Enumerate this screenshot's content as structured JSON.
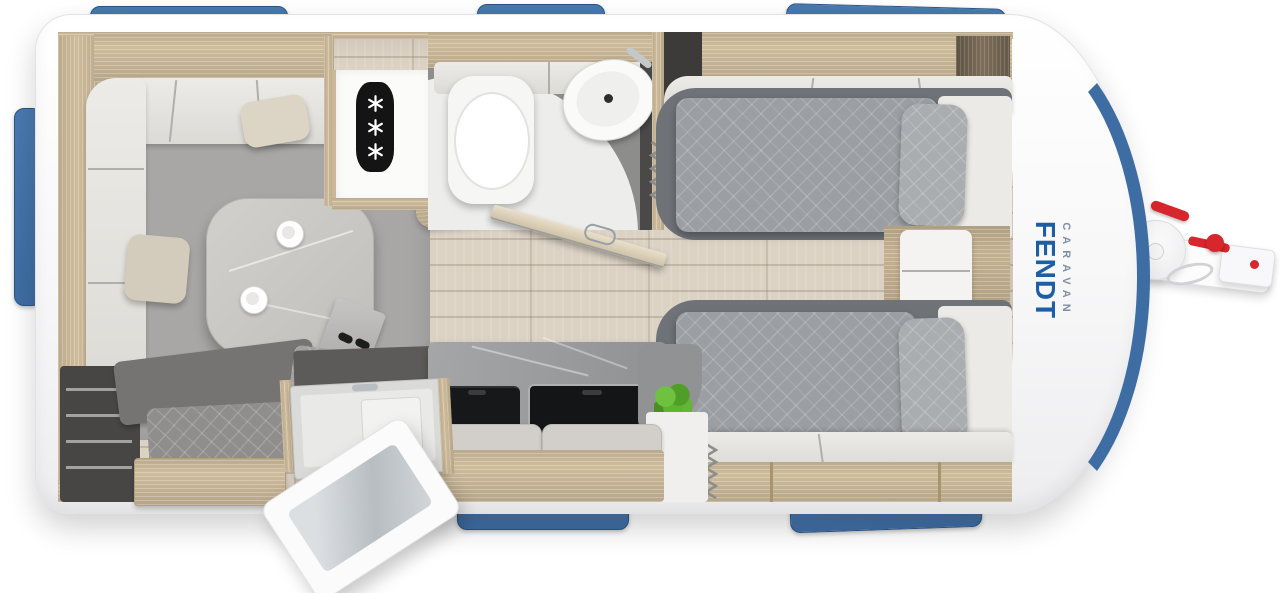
{
  "brand": {
    "name": "FENDT",
    "subtitle": "CARAVAN"
  },
  "colors": {
    "brand_blue": "#1d5fa7",
    "brand_sub": "#7e8ea3",
    "window_blue": "#3e6da3",
    "accent_red": "#d7262c",
    "wood": "#cfbc9b",
    "floor_wood": "#dbd2c4",
    "carpet_gray": "#a8a7a5",
    "bed_platform": "#6f7378",
    "duvet_gray": "#9b9ea2",
    "counter_gray": "#97999b",
    "stove_black": "#17181a",
    "plant_green": "#5cb52c",
    "body_white": "#ffffff",
    "bath_floor": "#8d8d8b"
  },
  "icons": {
    "fridge_freezer": "snowflake-asterisk-x3",
    "heater": "zigzag-coil",
    "window": "blue-window-tab"
  },
  "counts": {
    "window_tabs": 6,
    "snowflakes": 3,
    "beds": 2
  }
}
